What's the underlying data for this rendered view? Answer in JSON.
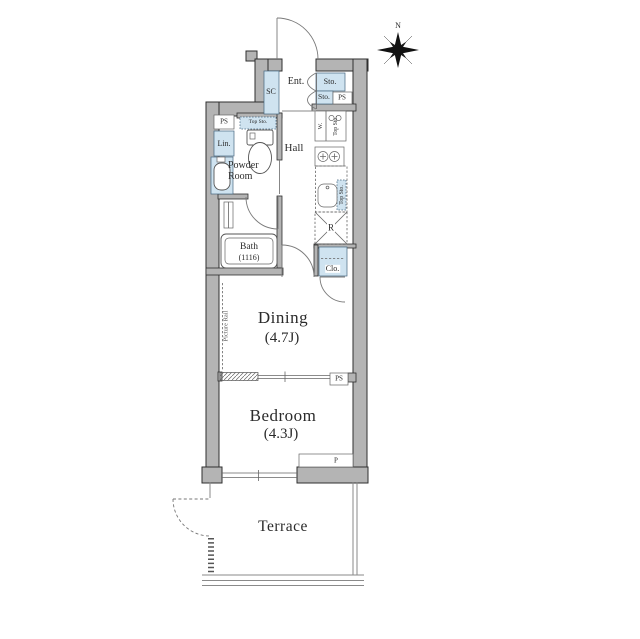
{
  "colors": {
    "wall_gray": "#b4b4b4",
    "wall_outline": "#2f2f2f",
    "fixture_blue": "#cfe3f0",
    "line_gray": "#666666",
    "text": "#2b2b2b"
  },
  "compass": {
    "north_label": "N"
  },
  "plan": {
    "entrance": {
      "label": "Ent.",
      "shoe_closet": "SC",
      "storage_upper": "Sto.",
      "storage_lower": "Sto.",
      "pipe_space": "PS"
    },
    "hall": {
      "label": "Hall",
      "washer": "W.",
      "washer_top_storage": "Top Sto.",
      "sink_top_storage": "Top Sto.",
      "refrigerator": "R",
      "closet": "Clo."
    },
    "powder_room": {
      "label": "Powder Room",
      "pipe_space": "PS",
      "toilet_top_storage": "Top Sto.",
      "linen": "Lin."
    },
    "bath": {
      "label": "Bath",
      "size": "(1116)"
    },
    "dining": {
      "label": "Dining",
      "size": "(4.7J)",
      "picture_rail": "Picture Rail",
      "pipe_space": "PS"
    },
    "bedroom": {
      "label": "Bedroom",
      "size": "(4.3J)",
      "pillar": "P"
    },
    "terrace": {
      "label": "Terrace"
    }
  }
}
